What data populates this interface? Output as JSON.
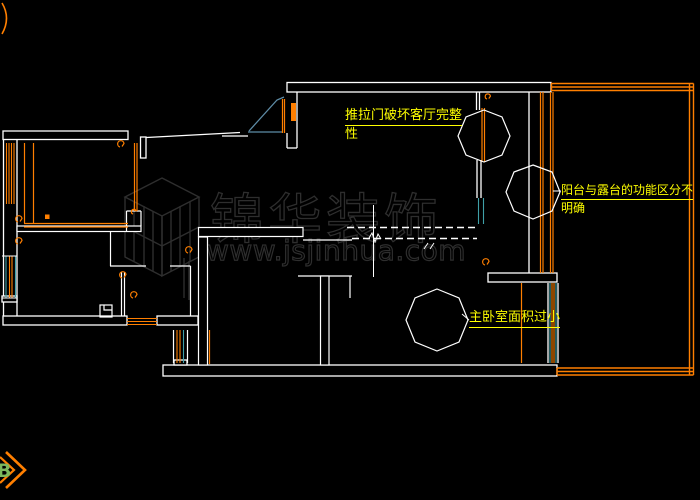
{
  "page": {
    "width": 700,
    "height": 500,
    "background": "#000000"
  },
  "palette": {
    "wall_white": "#FFFFFF",
    "cad_orange": "#FF7F00",
    "annotation_yellow": "#FFFF00",
    "door_blue": "#5E8CA6",
    "window_teal": "#3FA0A8",
    "watermark_gray": "#2E2E2E",
    "marker_green": "#7CB85C"
  },
  "annotations": {
    "sliding_door": {
      "line1": "推拉门破坏客厅完整",
      "line2": "性"
    },
    "balcony": {
      "line1": "阳台与露台的功能区分不",
      "line2": "明确"
    },
    "master_bedroom": {
      "text": "主卧室面积过小"
    }
  },
  "watermark": {
    "brand": "锦华装饰",
    "website": "www.jsjinhua.com"
  },
  "corner_marker": {
    "label": "B"
  }
}
